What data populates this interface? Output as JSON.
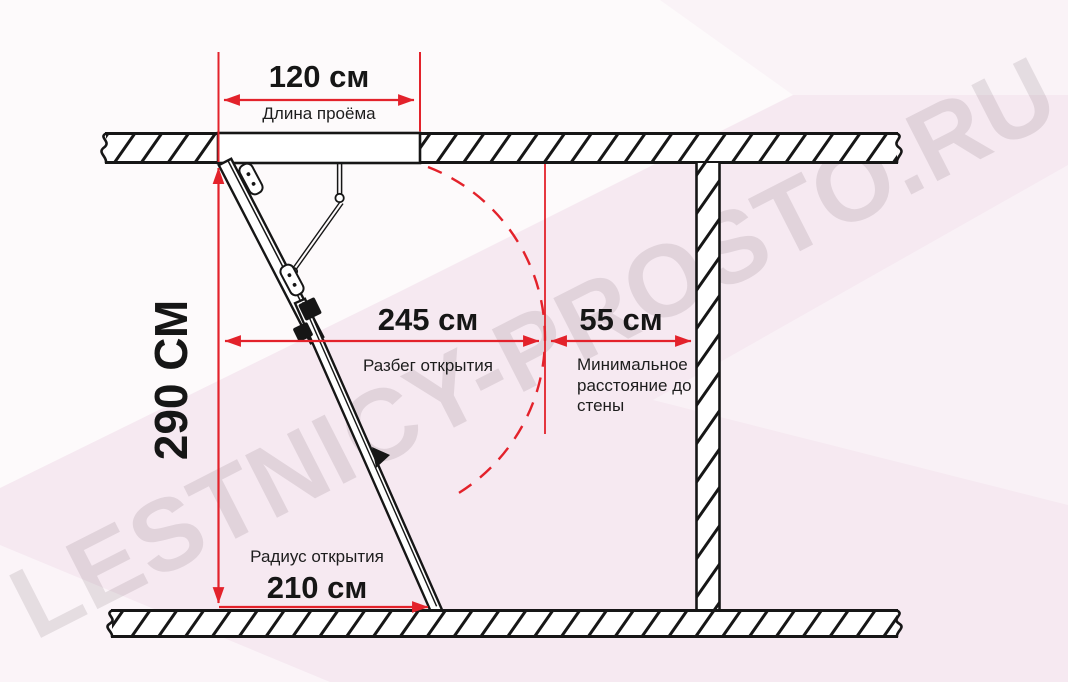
{
  "watermark": {
    "text": "LESTNICY-PROSTO.RU"
  },
  "colors": {
    "dimension_red": "#e3222b",
    "line_black": "#161616",
    "background_pink": "#f6e9f1"
  },
  "dimensions": {
    "opening_length": {
      "value": "120 см",
      "label": "Длина проёма"
    },
    "ceiling_height": {
      "value": "290 СМ"
    },
    "opening_run": {
      "value": "245 см",
      "label": "Разбег открытия"
    },
    "wall_distance": {
      "value": "55 см",
      "label": "Минимальное расстояние до стены"
    },
    "opening_radius": {
      "value": "210 см",
      "label": "Радиус открытия"
    }
  }
}
